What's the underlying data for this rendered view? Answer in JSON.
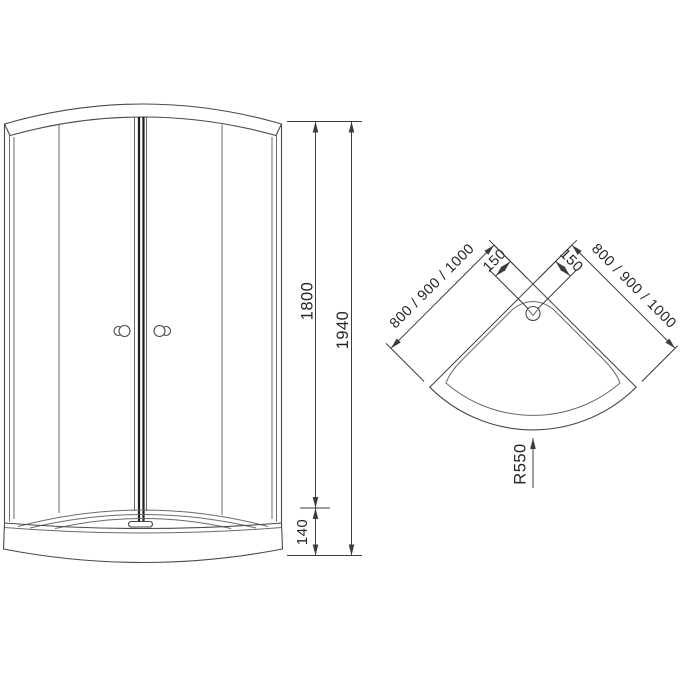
{
  "front_view": {
    "glass_height": "1800",
    "total_height": "1940",
    "tray_height": "140"
  },
  "plan_view": {
    "left_width_options": "800 / 900 / 1000",
    "right_width_options": "800 / 900 / 1000",
    "drain_offset_left": "150",
    "drain_offset_right": "150",
    "front_radius": "R550"
  },
  "colors": {
    "line": "#4a4a4a",
    "line_bold": "#1e1e1e",
    "dimension_line": "#3c3c3c",
    "text": "#262626",
    "background": "#ffffff"
  }
}
